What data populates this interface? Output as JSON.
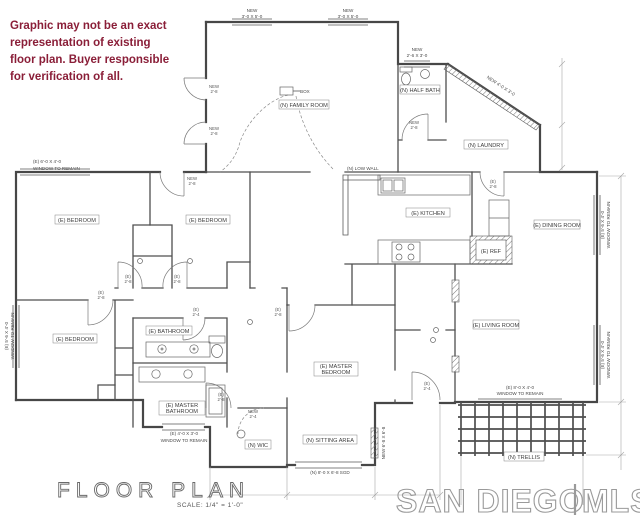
{
  "disclaimer": {
    "lines": [
      "Graphic may not be an exact",
      "representation of existing",
      "floor plan. Buyer responsible",
      "for verification of all."
    ]
  },
  "title": {
    "name": "FLOOR PLAN",
    "scale": "SCALE: 1/4\" = 1'-0\""
  },
  "watermark": {
    "brand": "SAN DIEGO",
    "divider": "|",
    "suffix": "MLS"
  },
  "colors": {
    "disclaimer": "#8a1e38",
    "walls": "#474747",
    "watermark": "#9a9a9a"
  },
  "rooms": {
    "family_room": "(N) FAMILY ROOM",
    "half_bath": "(N) HALF BATH",
    "laundry": "(N) LAUNDRY",
    "kitchen": "(E) KITCHEN",
    "dining": "(E) DINING ROOM",
    "living": "(E) LIVING ROOM",
    "bedroom1": "(E) BEDROOM",
    "bedroom2": "(E) BEDROOM",
    "bedroom3": "(E) BEDROOM",
    "bathroom": "(E) BATHROOM",
    "master_bath_l1": "(E) MASTER",
    "master_bath_l2": "BATHROOM",
    "master_bed_l1": "(E) MASTER",
    "master_bed_l2": "BEDROOM",
    "sitting": "(N) SITTING AREA",
    "wic": "(N) WIC",
    "trellis": "(N) TRELLIS",
    "ref": "(E) REF",
    "low_wall": "(N) LOW WALL",
    "box": "BOX"
  },
  "windows": {
    "new_top_a_l1": "NEW",
    "new_top_a_l2": "3'-0 X 5'-0",
    "new_top_b_l1": "NEW",
    "new_top_b_l2": "3'-0 X 5'-0",
    "new_half_bath_l1": "NEW",
    "new_half_bath_l2": "2'-6 X 3'-0",
    "new_diagonal": "NEW 4'-0 X 3'-0",
    "remain_top_left_l1": "(E) 6'-0 X 4'-0",
    "remain_top_left_l2": "WINDOW TO REMAIN",
    "remain_left_l1": "(E) 5'-6 X 4'-0",
    "remain_left_l2": "WINDOW TO REMAIN",
    "remain_right_upper_l1": "(E) 5'-6 X 4'-0",
    "remain_right_upper_l2": "WINDOW TO REMAIN",
    "remain_right_lower_l1": "(E) 5'-6 X 4'-0",
    "remain_right_lower_l2": "WINDOW TO REMAIN",
    "remain_bottom_l1": "(E) 4'-0 X 3'-0",
    "remain_bottom_l2": "WINDOW TO REMAIN",
    "remain_living_l1": "(E) 8'-0 X 4'-0",
    "remain_living_l2": "WINDOW TO REMAIN",
    "sgd": "(N) 8'-0 X 6'-8 SGD",
    "sitting_side": "NEW 6'-8 X 6'-8"
  },
  "doors": [
    {
      "l1": "NEW",
      "l2": "2'-8"
    },
    {
      "l1": "NEW",
      "l2": "2'-8"
    },
    {
      "l1": "NEW",
      "l2": "2'-8"
    },
    {
      "l1": "NEW",
      "l2": "2'-8"
    },
    {
      "l1": "(E)",
      "l2": "2'-8"
    },
    {
      "l1": "(E)",
      "l2": "2'-8"
    },
    {
      "l1": "(E)",
      "l2": "2'-8"
    },
    {
      "l1": "(E)",
      "l2": "2'-4"
    },
    {
      "l1": "(E)",
      "l2": "2'-8"
    },
    {
      "l1": "NEW",
      "l2": "2'-4"
    },
    {
      "l1": "(E)",
      "l2": "2'-4"
    },
    {
      "l1": "(E)",
      "l2": "2'-8"
    },
    {
      "l1": "(E)",
      "l2": "2'-8"
    }
  ]
}
